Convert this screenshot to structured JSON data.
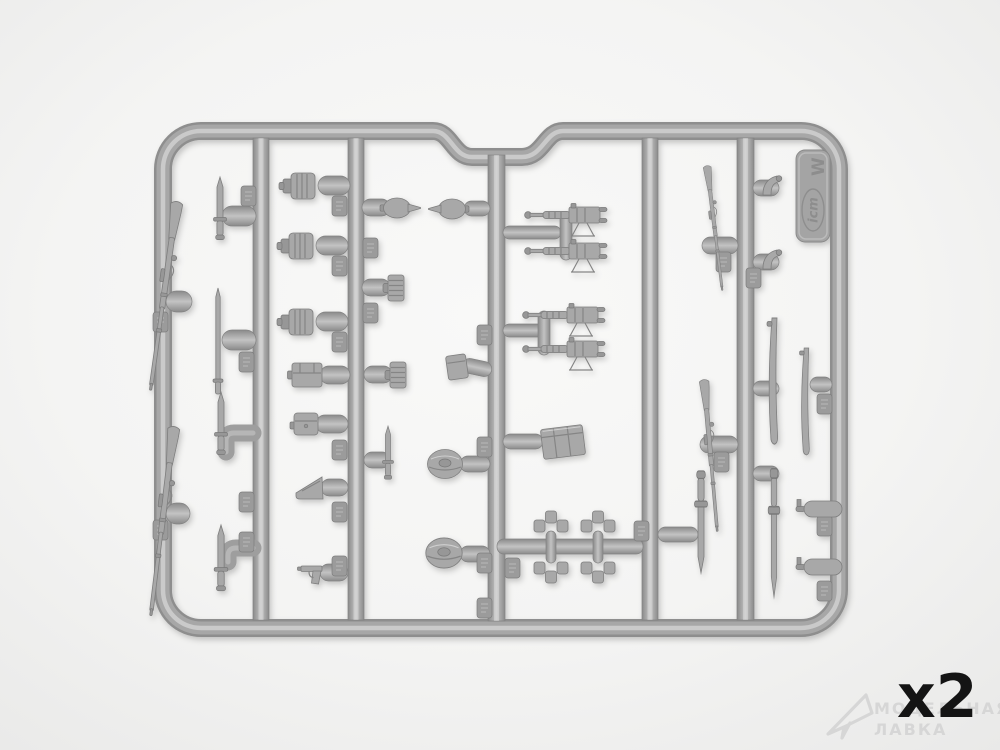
{
  "scene": {
    "description": "Product photo of a gray injection-molded plastic sprue (parts frame) from a model kit, holding WWI-era infantry weapons and equipment, on a white background",
    "background_hex": "#f3f3f2",
    "plastic_hex": "#a7a7a7"
  },
  "sprue": {
    "brand_tag": {
      "brand": "icm",
      "mold_letter": "W"
    },
    "parts_inventory": [
      {
        "name": "rifle",
        "count": 4
      },
      {
        "name": "bayonet",
        "count": 5
      },
      {
        "name": "cleaning-rod",
        "count": 1
      },
      {
        "name": "scabbard",
        "count": 2
      },
      {
        "name": "canteen-drum",
        "count": 3
      },
      {
        "name": "ribbed-drum",
        "count": 2
      },
      {
        "name": "lemon-grenade",
        "count": 2
      },
      {
        "name": "machine-gun",
        "count": 4
      },
      {
        "name": "ammo-box",
        "count": 1
      },
      {
        "name": "pouch",
        "count": 1
      },
      {
        "name": "ammo-crate",
        "count": 1
      },
      {
        "name": "small-box",
        "count": 1
      },
      {
        "name": "helmet-oval",
        "count": 2
      },
      {
        "name": "pouch-cluster",
        "count": 2
      },
      {
        "name": "bell-cone",
        "count": 2
      },
      {
        "name": "torpedo-part",
        "count": 2
      },
      {
        "name": "pistol",
        "count": 1
      },
      {
        "name": "funnel-wedge",
        "count": 1
      }
    ]
  },
  "overlay": {
    "quantity_label": "x2",
    "quantity_color": "#141414"
  },
  "watermark": {
    "line1": "МОДЕЛЬНАЯ",
    "line2": "ЛАВКА",
    "logo": "paper-plane-icon",
    "color": "#d4d4d4"
  }
}
